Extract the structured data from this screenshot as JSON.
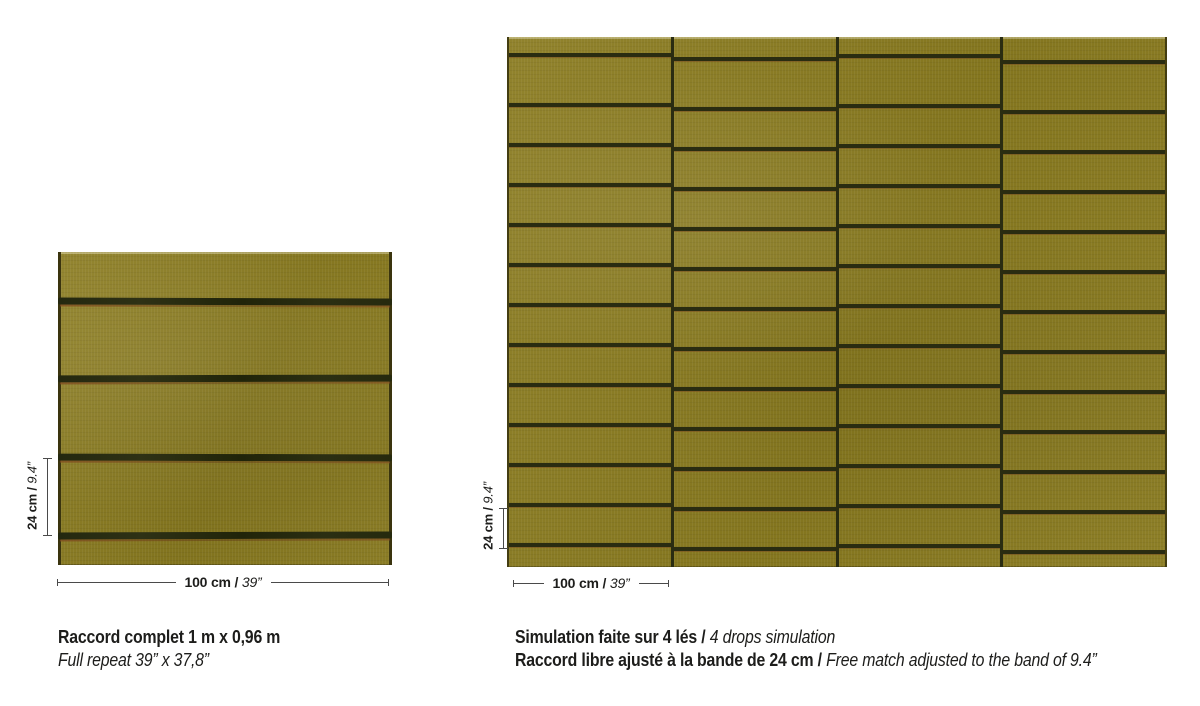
{
  "colors": {
    "olive": "#8a7b20",
    "stripe-dark": "#2a2c11",
    "stripe-brown": "#7a4e22",
    "dim-line": "#4a4a4a",
    "text": "#1d1d1b"
  },
  "left_panel": {
    "dim_height": {
      "metric": "24 cm",
      "sep": " / ",
      "imperial": "9.4”"
    },
    "dim_width": {
      "metric": "100 cm",
      "sep": " / ",
      "imperial": "39”"
    },
    "caption": {
      "line1": "Raccord complet 1 m x 0,96 m",
      "line2": "Full repeat 39” x 37,8”"
    }
  },
  "right_panel": {
    "dim_height": {
      "metric": "24 cm",
      "sep": " / ",
      "imperial": "9.4”"
    },
    "dim_width": {
      "metric": "100 cm",
      "sep": " / ",
      "imperial": "39”"
    },
    "caption": {
      "line1_fr": "Simulation faite sur 4 lés / ",
      "line1_en": "4 drops simulation",
      "line2_fr": "Raccord libre ajusté à la bande de 24 cm / ",
      "line2_en": "Free match adjusted to the band of 9.4”"
    }
  }
}
